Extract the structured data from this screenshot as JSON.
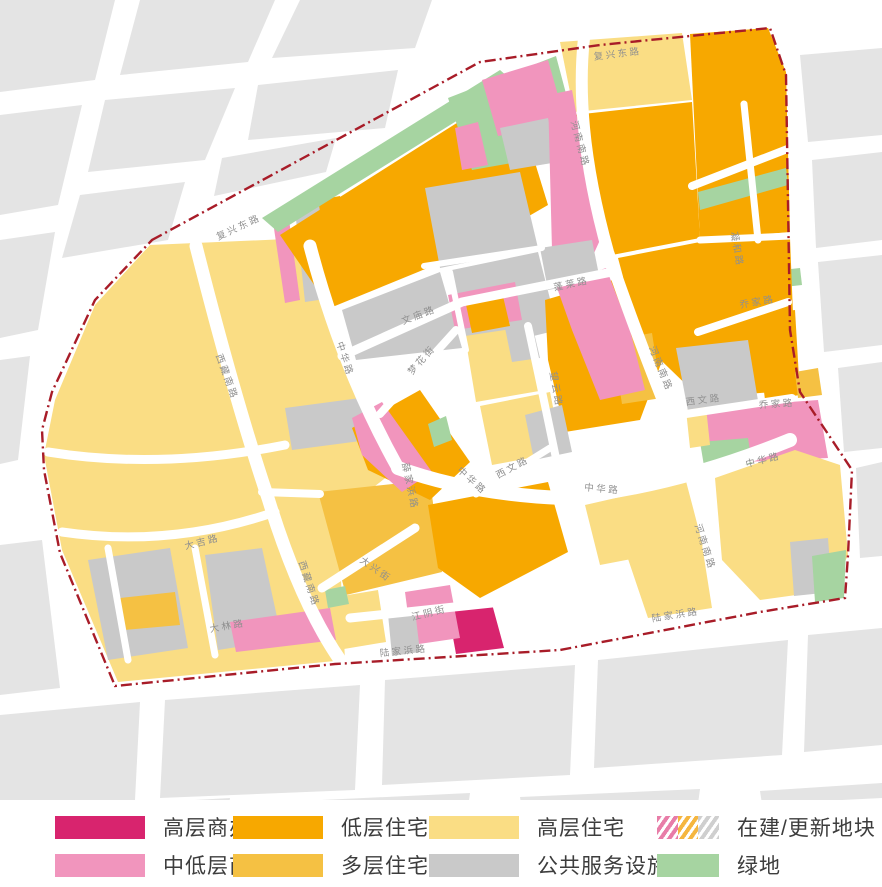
{
  "legend": {
    "items": [
      {
        "label": "高层商办",
        "type": "solid",
        "color": "#D8246E",
        "small": false
      },
      {
        "label": "低层住宅",
        "type": "solid",
        "color": "#F7A800",
        "small": false
      },
      {
        "label": "高层住宅",
        "type": "solid",
        "color": "#FADD84",
        "small": false
      },
      {
        "label": "在建/更新地块",
        "type": "hatch",
        "hatch_colors": [
          "#E87DA8",
          "#F5B63F",
          "#CFCFCF"
        ],
        "small": true
      },
      {
        "label": "中低层商办",
        "type": "solid",
        "color": "#F195BD",
        "small": false
      },
      {
        "label": "多层住宅",
        "type": "solid",
        "color": "#F5C143",
        "small": false
      },
      {
        "label": "公共服务设施",
        "type": "solid",
        "color": "#C9C9C9",
        "small": false
      },
      {
        "label": "绿地",
        "type": "solid",
        "color": "#A6D4A1",
        "small": true
      }
    ]
  },
  "map": {
    "width": 882,
    "height": 800,
    "colors": {
      "hy": "#FADD84",
      "ly": "#F7A800",
      "my": "#F5C143",
      "hp": "#D8246E",
      "mp": "#F195BD",
      "ps": "#C9C9C9",
      "gr": "#A6D4A1",
      "bg_block": "#E4E4E4",
      "boundary": "#A81C28",
      "road_label": "#8f8f8f"
    },
    "boundary_path": "M152,240 L480,62 L600,45 L770,28 L786,75 L790,330 L800,392 L852,470 L848,555 L845,598 L760,612 L560,650 L335,664 L115,686 L60,553 L44,470 L42,430 L52,392 L95,300 Z",
    "bg_blocks": [
      "0,0 115,0 95,80 0,92",
      "140,0 275,0 248,62 120,75",
      "300,0 432,0 415,48 272,58",
      "0,115 82,105 58,205 0,215",
      "105,100 235,88 205,160 88,172",
      "258,85 398,70 385,128 248,140",
      "0,240 55,232 38,330 0,338",
      "80,195 185,182 168,240 62,258",
      "222,158 336,138 326,172 214,196",
      "800,55 882,48 882,135 808,142",
      "812,160 882,152 882,240 816,248",
      "818,262 882,255 882,345 824,352",
      "838,368 882,362 882,448 844,452",
      "856,468 882,462 882,556 860,558",
      "0,715 140,702 135,800 0,808",
      "165,700 360,685 355,790 160,798",
      "385,680 575,665 570,775 382,785",
      "598,660 788,640 782,755 594,768",
      "808,635 882,628 882,745 804,752",
      "0,360 30,356 18,460 0,464",
      "0,545 42,540 60,688 0,695",
      "90,806 230,798 228,812 92,820",
      "300,801 470,793 468,808 302,814",
      "520,797 700,789 698,804 522,810",
      "760,791 882,783 882,798 762,804"
    ],
    "parcels": [
      {
        "cat": "hy",
        "pts": "150,245 310,238 345,365 398,468 370,490 340,560 345,660 118,682 62,550 44,455 55,400 95,305"
      },
      {
        "cat": "ps",
        "pts": "88,560 170,548 188,648 108,660"
      },
      {
        "cat": "ps",
        "pts": "205,555 262,548 282,640 218,650"
      },
      {
        "cat": "my",
        "pts": "120,598 175,592 180,625 124,630"
      },
      {
        "cat": "mp",
        "pts": "230,622 330,608 336,640 236,652"
      },
      {
        "cat": "ps",
        "pts": "285,408 360,398 368,440 292,450"
      },
      {
        "cat": "mp",
        "pts": "272,215 288,212 300,300 285,303"
      },
      {
        "cat": "ps",
        "pts": "295,210 320,206 332,298 305,302"
      },
      {
        "cat": "ly",
        "pts": "318,200 340,196 346,218 322,222"
      },
      {
        "cat": "gr",
        "pts": "262,218 500,70 516,84 278,232"
      },
      {
        "cat": "ly",
        "pts": "280,235 512,88 548,205 470,250 418,272 330,308"
      },
      {
        "cat": "ps",
        "pts": "425,188 520,172 538,248 440,268"
      },
      {
        "cat": "ps",
        "pts": "342,310 440,272 462,348 356,360"
      },
      {
        "cat": "ps",
        "pts": "452,270 538,252 558,330 468,352"
      },
      {
        "cat": "mp",
        "pts": "448,295 515,282 522,320 455,330"
      },
      {
        "cat": "ly",
        "pts": "465,300 502,292 510,326 472,333"
      },
      {
        "cat": "gr",
        "pts": "448,98 556,56 580,146 540,158 472,170"
      },
      {
        "cat": "mp",
        "pts": "482,80 548,60 565,120 540,128 498,136"
      },
      {
        "cat": "ps",
        "pts": "500,128 548,118 558,162 510,170"
      },
      {
        "cat": "mp",
        "pts": "455,128 478,122 488,165 462,170"
      },
      {
        "cat": "hy",
        "pts": "560,42 682,33 692,100 574,112"
      },
      {
        "cat": "ly",
        "pts": "574,115 692,102 700,238 612,255 592,180"
      },
      {
        "cat": "ly",
        "pts": "690,34 768,28 786,72 790,232 700,240"
      },
      {
        "cat": "gr",
        "pts": "698,192 786,168 788,185 700,210"
      },
      {
        "cat": "gr",
        "pts": "782,270 800,268 802,285 784,287"
      },
      {
        "cat": "ly",
        "pts": "618,258 700,242 790,238 796,390 700,398 640,340"
      },
      {
        "cat": "ly",
        "pts": "545,300 640,272 668,345 640,420 565,432 548,360"
      },
      {
        "cat": "ps",
        "pts": "676,348 748,340 762,425 692,432"
      },
      {
        "cat": "my",
        "pts": "612,340 652,333 662,398 622,404"
      },
      {
        "cat": "mp",
        "pts": "548,95 572,90 600,240 590,262 552,250"
      },
      {
        "cat": "ps",
        "pts": "540,248 592,240 600,280 548,290"
      },
      {
        "cat": "mp",
        "pts": "556,285 606,268 630,330 645,390 600,400 572,330"
      },
      {
        "cat": "ly",
        "pts": "755,315 795,310 800,395 765,400"
      },
      {
        "cat": "my",
        "pts": "795,372 818,368 822,395 798,398"
      },
      {
        "cat": "mp",
        "pts": "705,408 818,400 828,458 745,462 708,448"
      },
      {
        "cat": "gr",
        "pts": "700,442 748,438 752,464 704,466"
      },
      {
        "cat": "hy",
        "pts": "686,410 706,407 710,445 690,448"
      },
      {
        "cat": "hy",
        "pts": "585,505 695,480 705,545 600,565"
      },
      {
        "cat": "hy",
        "pts": "625,550 700,532 712,608 648,618"
      },
      {
        "cat": "hy",
        "pts": "715,478 795,450 840,465 848,555 832,590 760,600 722,560"
      },
      {
        "cat": "ps",
        "pts": "790,542 828,538 832,592 794,596"
      },
      {
        "cat": "gr",
        "pts": "812,556 846,550 844,598 815,602"
      },
      {
        "cat": "my",
        "pts": "318,492 430,480 442,572 346,595"
      },
      {
        "cat": "ly",
        "pts": "352,428 420,390 470,462 430,500 368,470"
      },
      {
        "cat": "mp",
        "pts": "352,418 382,402 432,472 402,492 362,455"
      },
      {
        "cat": "gr",
        "pts": "428,424 446,416 452,440 434,447"
      },
      {
        "cat": "ly",
        "pts": "428,505 548,482 568,552 480,598 438,568"
      },
      {
        "cat": "hp",
        "pts": "448,610 492,604 504,648 456,654"
      },
      {
        "cat": "mp",
        "pts": "405,592 450,585 460,638 412,645"
      },
      {
        "cat": "hy",
        "pts": "330,598 378,590 386,642 338,650"
      },
      {
        "cat": "ps",
        "pts": "388,614 415,610 420,652 392,656"
      },
      {
        "cat": "gr",
        "pts": "325,590 345,586 349,604 328,608"
      },
      {
        "cat": "hy",
        "pts": "465,336 532,326 545,390 476,402"
      },
      {
        "cat": "ps",
        "pts": "505,328 532,324 540,358 512,362"
      },
      {
        "cat": "hy",
        "pts": "480,406 550,392 562,452 492,465"
      },
      {
        "cat": "ps",
        "pts": "525,415 562,405 572,452 534,460"
      }
    ],
    "roads": [
      {
        "d": "M196,246 Q235,400 268,498 Q300,602 340,660",
        "w": 13
      },
      {
        "d": "M310,246 Q342,368 398,468",
        "w": 13
      },
      {
        "d": "M398,468 Q470,494 562,498 Q672,488 790,440",
        "w": 14
      },
      {
        "d": "M584,38 Q574,130 608,252 Q638,340 686,458",
        "w": 12
      },
      {
        "d": "M686,458 Q706,532 726,614",
        "w": 12
      },
      {
        "d": "M342,356 L462,302 L612,272",
        "w": 9
      },
      {
        "d": "M380,414 L456,330",
        "w": 8
      },
      {
        "d": "M528,326 Q544,400 558,468",
        "w": 8
      },
      {
        "d": "M476,494 L550,448",
        "w": 7
      },
      {
        "d": "M686,414 L792,398",
        "w": 8
      },
      {
        "d": "M692,186 L790,148",
        "w": 8
      },
      {
        "d": "M744,104 L758,240",
        "w": 7
      },
      {
        "d": "M698,332 L788,302",
        "w": 8
      },
      {
        "d": "M424,266 L542,248",
        "w": 6
      },
      {
        "d": "M450,272 L466,350",
        "w": 6
      },
      {
        "d": "M322,588 L415,528",
        "w": 9
      },
      {
        "d": "M350,618 L520,600",
        "w": 9
      },
      {
        "d": "M262,492 L320,494",
        "w": 8
      },
      {
        "d": "M62,532 Q170,548 275,512",
        "w": 9
      },
      {
        "d": "M48,452 Q160,470 285,445",
        "w": 9
      },
      {
        "d": "M108,548 L128,660",
        "w": 7
      },
      {
        "d": "M195,548 L215,655",
        "w": 7
      },
      {
        "d": "M700,240 L790,236",
        "w": 7
      }
    ],
    "road_labels": [
      {
        "t": "复兴东路",
        "x": 618,
        "y": 57,
        "r": -7
      },
      {
        "t": "复兴东路",
        "x": 240,
        "y": 230,
        "r": -25
      },
      {
        "t": "西藏南路",
        "x": 224,
        "y": 378,
        "r": 70
      },
      {
        "t": "西藏南路",
        "x": 306,
        "y": 585,
        "r": 72
      },
      {
        "t": "中华路",
        "x": 342,
        "y": 360,
        "r": 72
      },
      {
        "t": "中华路",
        "x": 470,
        "y": 483,
        "r": 42
      },
      {
        "t": "中华路",
        "x": 602,
        "y": 492,
        "r": 5
      },
      {
        "t": "中华路",
        "x": 764,
        "y": 463,
        "r": -14
      },
      {
        "t": "河南南路",
        "x": 577,
        "y": 145,
        "r": 75
      },
      {
        "t": "河南南路",
        "x": 658,
        "y": 370,
        "r": 68
      },
      {
        "t": "河南南路",
        "x": 702,
        "y": 548,
        "r": 72
      },
      {
        "t": "陆家浜路",
        "x": 404,
        "y": 654,
        "r": -6
      },
      {
        "t": "陆家浜路",
        "x": 676,
        "y": 618,
        "r": -9
      },
      {
        "t": "文庙路",
        "x": 420,
        "y": 318,
        "r": -21
      },
      {
        "t": "蓬莱路",
        "x": 572,
        "y": 287,
        "r": -12
      },
      {
        "t": "梦花街",
        "x": 424,
        "y": 362,
        "r": -48
      },
      {
        "t": "望云路",
        "x": 553,
        "y": 390,
        "r": 80
      },
      {
        "t": "大兴街",
        "x": 374,
        "y": 572,
        "r": 35
      },
      {
        "t": "江阴街",
        "x": 430,
        "y": 616,
        "r": -14
      },
      {
        "t": "薛家浜路",
        "x": 407,
        "y": 487,
        "r": 78
      },
      {
        "t": "西文路",
        "x": 514,
        "y": 470,
        "r": -28
      },
      {
        "t": "西文路",
        "x": 704,
        "y": 403,
        "r": -7
      },
      {
        "t": "乔家路",
        "x": 777,
        "y": 407,
        "r": -4
      },
      {
        "t": "乔家路",
        "x": 758,
        "y": 305,
        "r": -10
      },
      {
        "t": "凝和路",
        "x": 734,
        "y": 250,
        "r": 80
      },
      {
        "t": "大吉路",
        "x": 203,
        "y": 545,
        "r": -14
      },
      {
        "t": "大林路",
        "x": 228,
        "y": 629,
        "r": -10
      }
    ]
  }
}
